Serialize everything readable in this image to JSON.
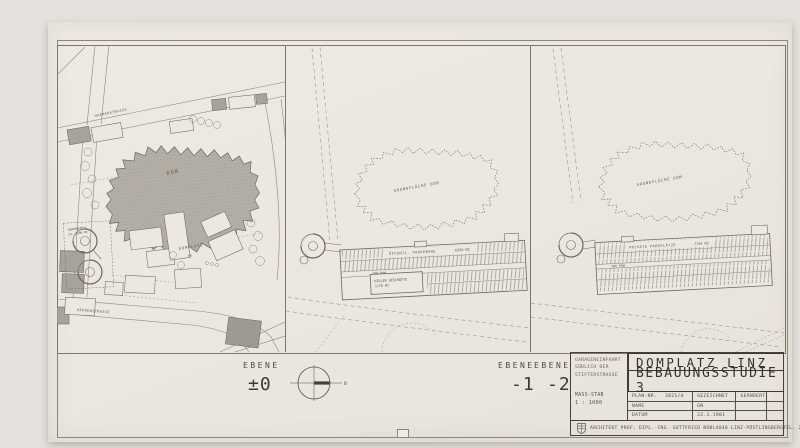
{
  "sheet": {
    "compass": {
      "north": "N"
    },
    "panels": [
      {
        "ebene": "EBENE",
        "level": "±0",
        "streets": {
          "top": "HAFNERSTRASSE",
          "bottom": "HERRENSTRASSE"
        },
        "dom": "DOM",
        "platz": "DOMPLATZ",
        "platz_level": "±0",
        "ramp": {
          "line1": "RAMPENAREAL",
          "line2": "CA. 1300 M2"
        }
      },
      {
        "ebene": "EBENE",
        "level": "-1",
        "dom": "GRUNDFLÄCHE DOM",
        "parking": {
          "label": "ÖFFENTL. PARKEBENE",
          "area": "6950 M2",
          "cars": "240 PKW"
        },
        "keller": {
          "line1": "KELLER GESCHÄFTE",
          "line2": "1170 M2"
        }
      },
      {
        "ebene": "EBENE",
        "level": "-2",
        "dom": "GRUNDFLÄCHE DOM",
        "parking": {
          "label": "PRIVATE PARKPLÄTZE",
          "area": "7758 M2",
          "cars": "306 PKW"
        }
      }
    ],
    "title_block": {
      "note": {
        "line1": "GARAGENEINFAHRT",
        "line2": "SÜDLICH DER",
        "line3": "STIFTERSTRASSE"
      },
      "scale": {
        "label": "MASS-STAB",
        "value": "1 : 1000"
      },
      "title1": "DOMPLATZ LINZ",
      "title2": "BEBAUUNGSSTUDIE 3",
      "table": {
        "plan_label": "PLAN-NR.",
        "plan_value": "3821/4",
        "col2": "GEZEICHNET",
        "col3": "GEÄNDERT",
        "name_label": "NAME",
        "name_value": "GN",
        "datum_label": "DATUM",
        "datum_value": "22.1.1981"
      },
      "footer": {
        "architect": "ARCHITEKT PROF. DIPL.-ING. GOTTFRIED NOBL",
        "address": "4040 LINZ-PÖSTLINGBERG",
        "tel": "TEL. 23 24 81"
      }
    }
  }
}
